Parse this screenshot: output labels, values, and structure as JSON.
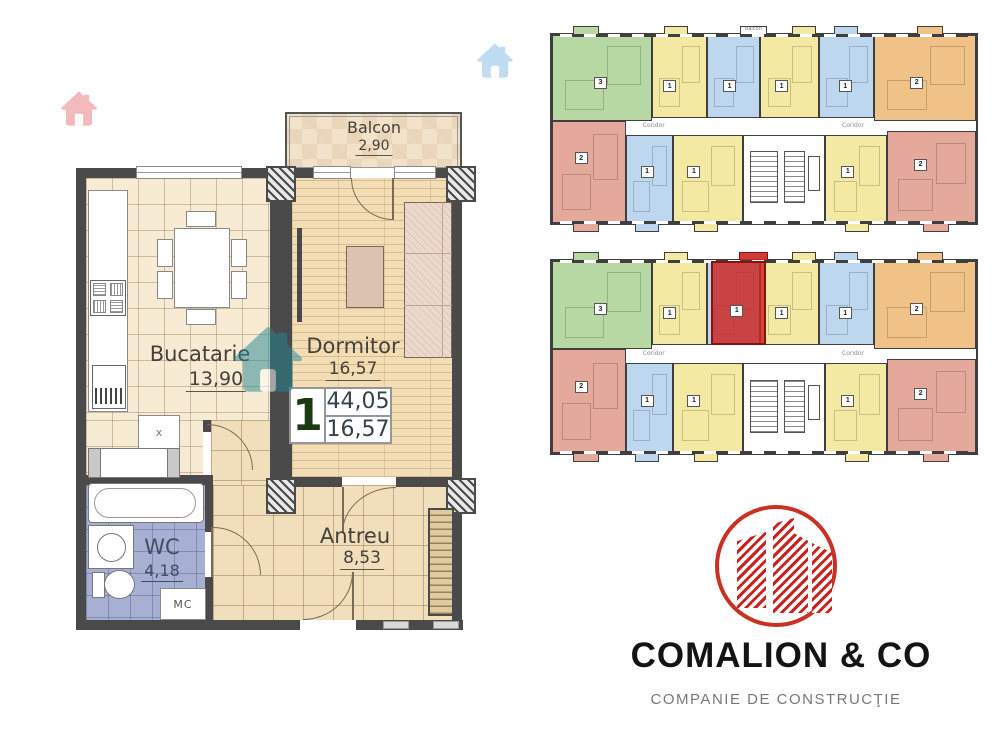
{
  "floorplan": {
    "badge": {
      "unit": "1",
      "total_area": "44,05",
      "living_area": "16,57"
    },
    "rooms": {
      "balcon": {
        "name": "Balcon",
        "area": "2,90"
      },
      "bucatarie": {
        "name": "Bucatarie",
        "area": "13,90"
      },
      "dormitor": {
        "name": "Dormitor",
        "area": "16,57"
      },
      "wc": {
        "name": "WC",
        "area": "4,18"
      },
      "antreu": {
        "name": "Antreu",
        "area": "8,53"
      }
    },
    "appliance_labels": {
      "washing_machine": "MC",
      "kitchen_sink": "x"
    }
  },
  "siteplan": {
    "corridor_label": "Coridor",
    "balcony_label": "Balcon",
    "colors": {
      "green": "#b7d7a3",
      "yellow": "#f3e9a3",
      "blue": "#bdd7ee",
      "orange": "#f0c287",
      "salmon": "#e5a99c",
      "highlight": "#cd2f29"
    },
    "top_plan": {
      "units": {
        "green": "3",
        "yellow1": "1",
        "blue1": "1",
        "yellow2": "1",
        "blue2": "1",
        "orange": "2",
        "salmon_left": "2",
        "blue3": "1",
        "yellow3": "1",
        "yellow4": "1",
        "salmon_right": "2"
      }
    },
    "bottom_plan": {
      "units": {
        "green": "3",
        "yellow1": "1",
        "yellow2": "1",
        "blue2": "1",
        "orange": "2",
        "salmon_left": "2",
        "blue3": "1",
        "yellow3": "1",
        "yellow4": "1",
        "salmon_right": "2"
      },
      "highlighted_unit": "1"
    }
  },
  "logo": {
    "company": "COMALION & CO",
    "tagline": "COMPANIE DE CONSTRUCŢIE",
    "brand_color": "#c8231f"
  }
}
